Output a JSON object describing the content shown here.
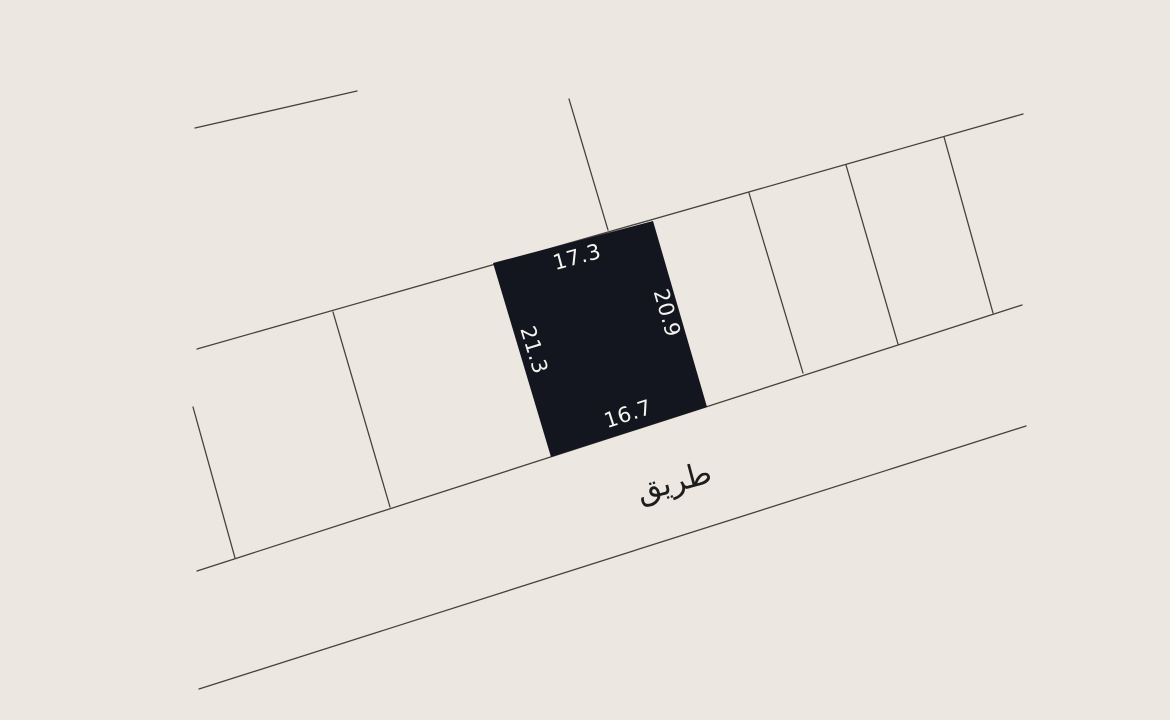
{
  "canvas": {
    "background_color": "#ece8e1",
    "line_color": "#45423c",
    "parcel_fill_color": "#14161f",
    "dimension_text_color": "#f5f3ee",
    "road_text_color": "#1e1d1b"
  },
  "selected_parcel": {
    "side_lengths": {
      "top": "17.3",
      "right": "20.9",
      "left": "21.3",
      "bottom": "16.7"
    }
  },
  "road": {
    "name_arabic": "طريق"
  }
}
